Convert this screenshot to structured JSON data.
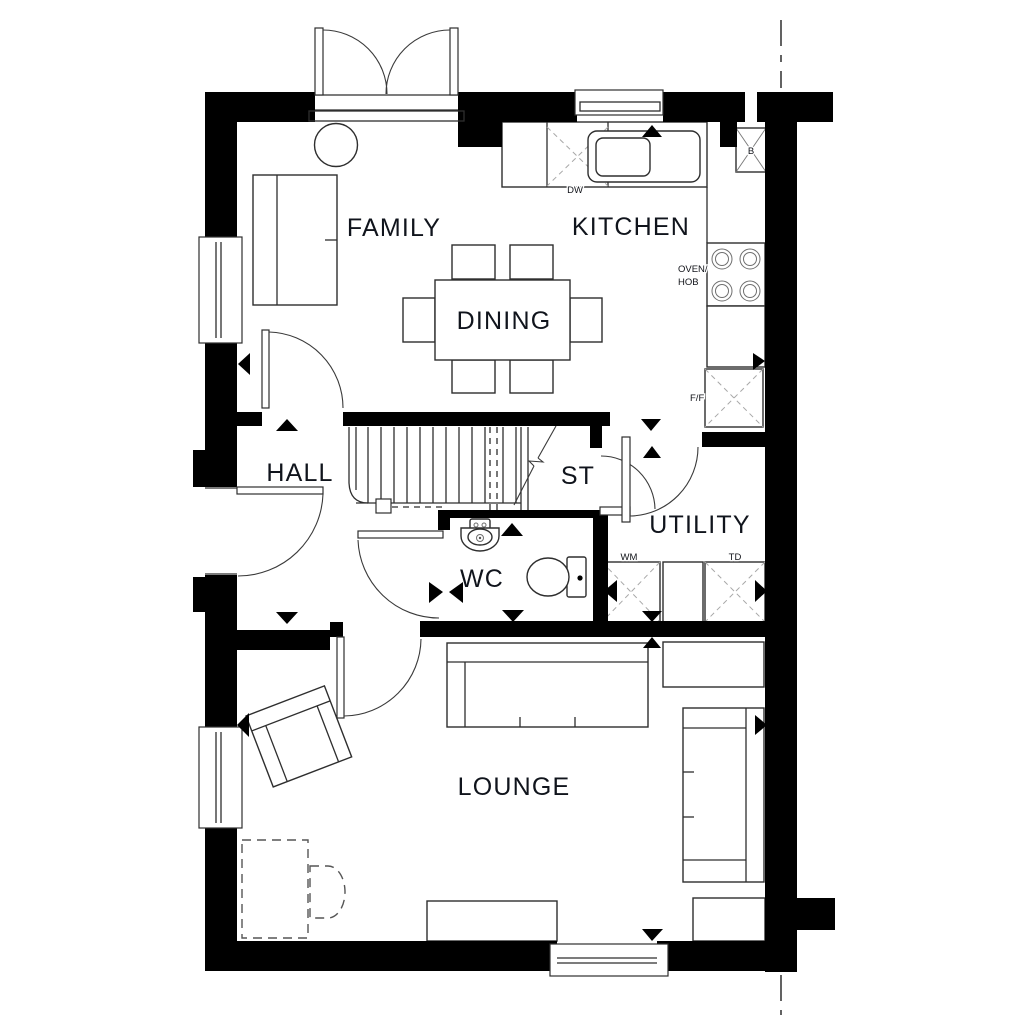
{
  "rooms": {
    "family": "FAMILY",
    "kitchen": "KITCHEN",
    "dining": "DINING",
    "hall": "HALL",
    "store": "ST",
    "utility": "UTILITY",
    "wc": "WC",
    "lounge": "LOUNGE"
  },
  "appliances": {
    "dishwasher": "DW",
    "boiler": "B",
    "oven_hob_line1": "OVEN/",
    "oven_hob_line2": "HOB",
    "fridge_freezer": "F/F",
    "washing_machine": "WM",
    "tumble_dryer": "TD"
  },
  "colors": {
    "background": "#ffffff",
    "wall": "#000000",
    "line": "#2e2e2e",
    "hatch": "#a8a8a8",
    "room_label": "#10141c",
    "small_label": "#111319"
  }
}
